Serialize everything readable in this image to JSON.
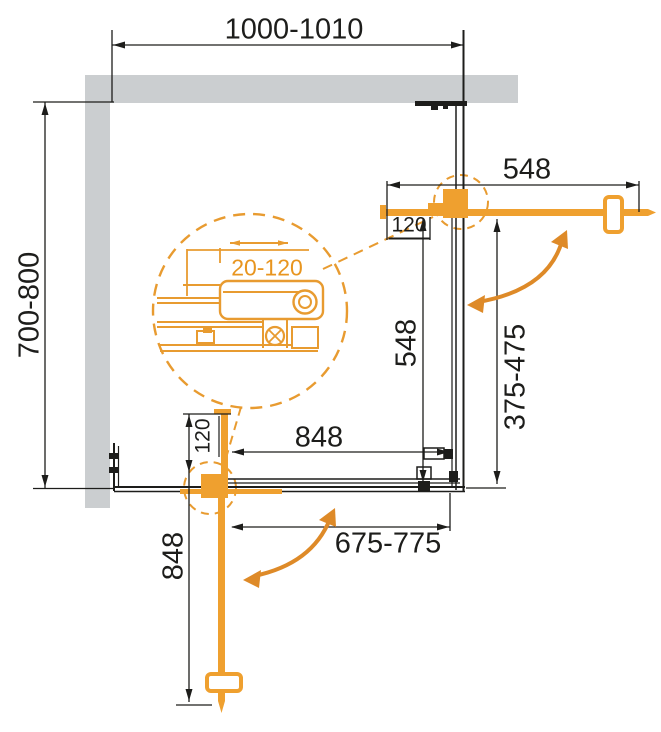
{
  "diagram": {
    "colors": {
      "wall_gray": "#cbced0",
      "line_black": "#1d1d1b",
      "profile_orange": "#efa02f",
      "arrow_orange": "#de8a28",
      "detail_orange": "#e89b30"
    },
    "labels": {
      "overall_width": "1000-1010",
      "overall_depth": "700-800",
      "top_door_width": "548",
      "top_hinge_offset": "120",
      "side_panel_width": "548",
      "right_opening_range": "375-475",
      "bottom_panel_width": "848",
      "bottom_opening_range": "675-775",
      "left_door_width": "848",
      "bottom_hinge_offset": "120",
      "adjustment_range": "20-120"
    }
  }
}
